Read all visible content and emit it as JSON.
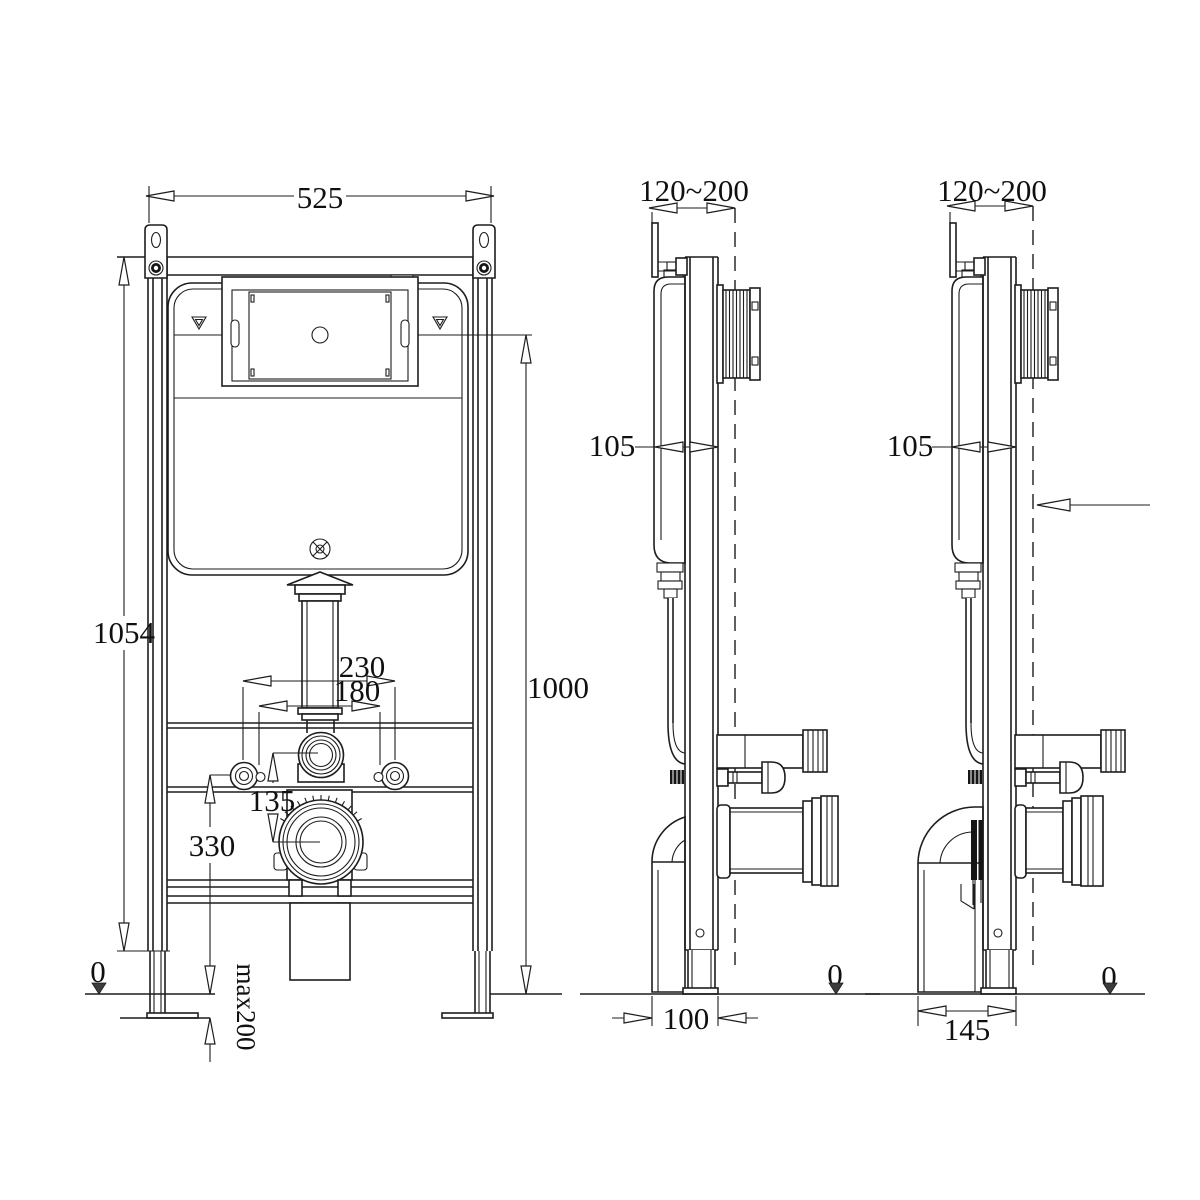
{
  "drawing": {
    "type": "technical-installation-drawing",
    "subject": "concealed-cistern-wc-frame",
    "background": "#ffffff",
    "line_color": "#1d1d1d",
    "views": {
      "front": {
        "dims": {
          "width": "525",
          "frame_height": "1054",
          "install_height": "1000",
          "bolt_spacing": "230",
          "hole_spacing": "180",
          "flush_drain_gap": "135",
          "drain_height": "330",
          "floor": "0",
          "leg_extension": "max200"
        }
      },
      "side_100": {
        "dims": {
          "wall_range": "120~200",
          "depth": "105",
          "drain_offset": "100",
          "floor": "0"
        }
      },
      "side_145": {
        "dims": {
          "wall_range": "120~200",
          "depth": "105",
          "drain_offset": "145",
          "floor": "0"
        }
      }
    }
  }
}
